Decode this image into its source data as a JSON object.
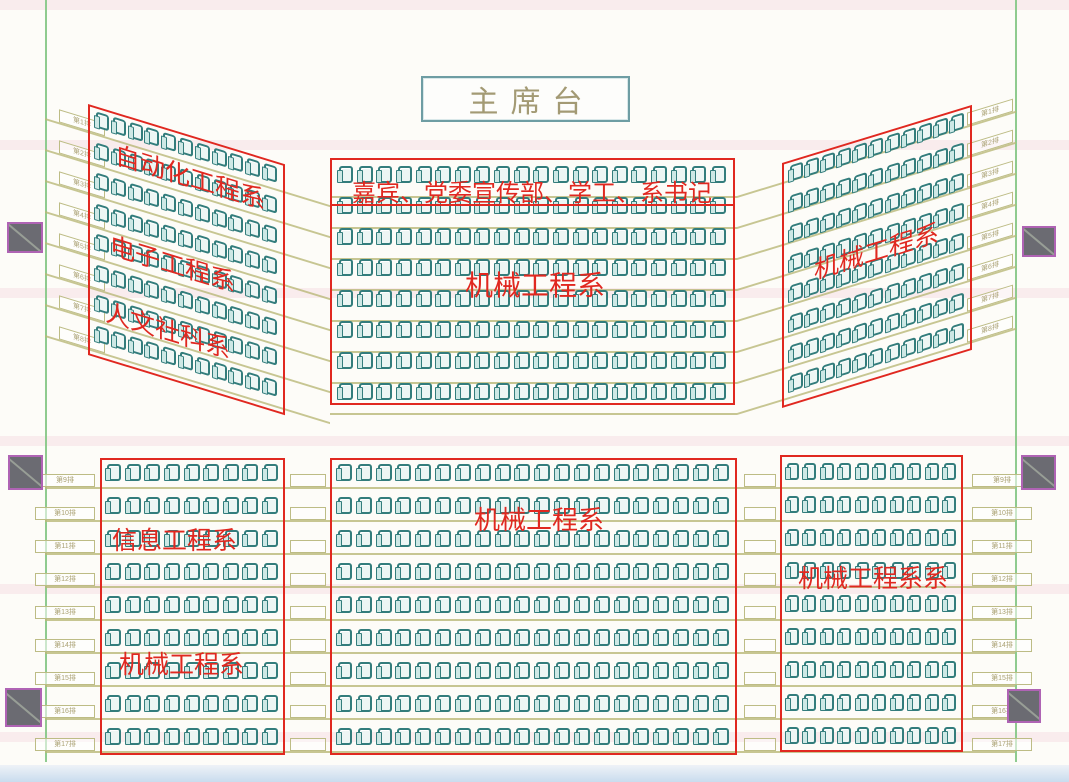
{
  "stage": {
    "label": "主席台"
  },
  "colors": {
    "boundary_red": "#e02820",
    "seat_teal": "#337d7c",
    "guide_olive": "#b9b878",
    "wall_green": "#8fcb8f",
    "pillar_gray": "#6b6b72",
    "pillar_accent": "#bb62c0",
    "stage_text": "#a39a74"
  },
  "sections": [
    {
      "id": "wing-left",
      "rows": 8,
      "seats_per_row": 11,
      "labels": [
        "自动化工程系",
        "电子工程系",
        "人文社科系"
      ]
    },
    {
      "id": "center-top",
      "rows": 8,
      "seats_per_row": 20,
      "labels": [
        "嘉宾、党委宣传部、学工、系书记",
        "机械工程系"
      ]
    },
    {
      "id": "wing-right",
      "rows": 8,
      "seats_per_row": 11,
      "labels": [
        "机械工程系"
      ]
    },
    {
      "id": "bottom-left",
      "rows": 9,
      "seats_per_row": 9,
      "labels": [
        "信息工程系",
        "机械工程系"
      ]
    },
    {
      "id": "bottom-center",
      "rows": 9,
      "seats_per_row": 20,
      "labels": [
        "机械工程系"
      ]
    },
    {
      "id": "bottom-right",
      "rows": 9,
      "seats_per_row": 10,
      "labels": [
        "机械工程系系"
      ]
    }
  ],
  "row_tags": {
    "top_left": [
      "第1排",
      "第2排",
      "第3排",
      "第4排",
      "第5排",
      "第6排",
      "第7排",
      "第8排"
    ],
    "top_right": [
      "第1排",
      "第2排",
      "第3排",
      "第4排",
      "第5排",
      "第6排",
      "第7排",
      "第8排"
    ],
    "bottom_left": [
      "第9排",
      "第10排",
      "第11排",
      "第12排",
      "第13排",
      "第14排",
      "第15排",
      "第16排",
      "第17排"
    ],
    "bottom_right": [
      "第9排",
      "第10排",
      "第11排",
      "第12排",
      "第13排",
      "第14排",
      "第15排",
      "第16排",
      "第17排"
    ]
  }
}
